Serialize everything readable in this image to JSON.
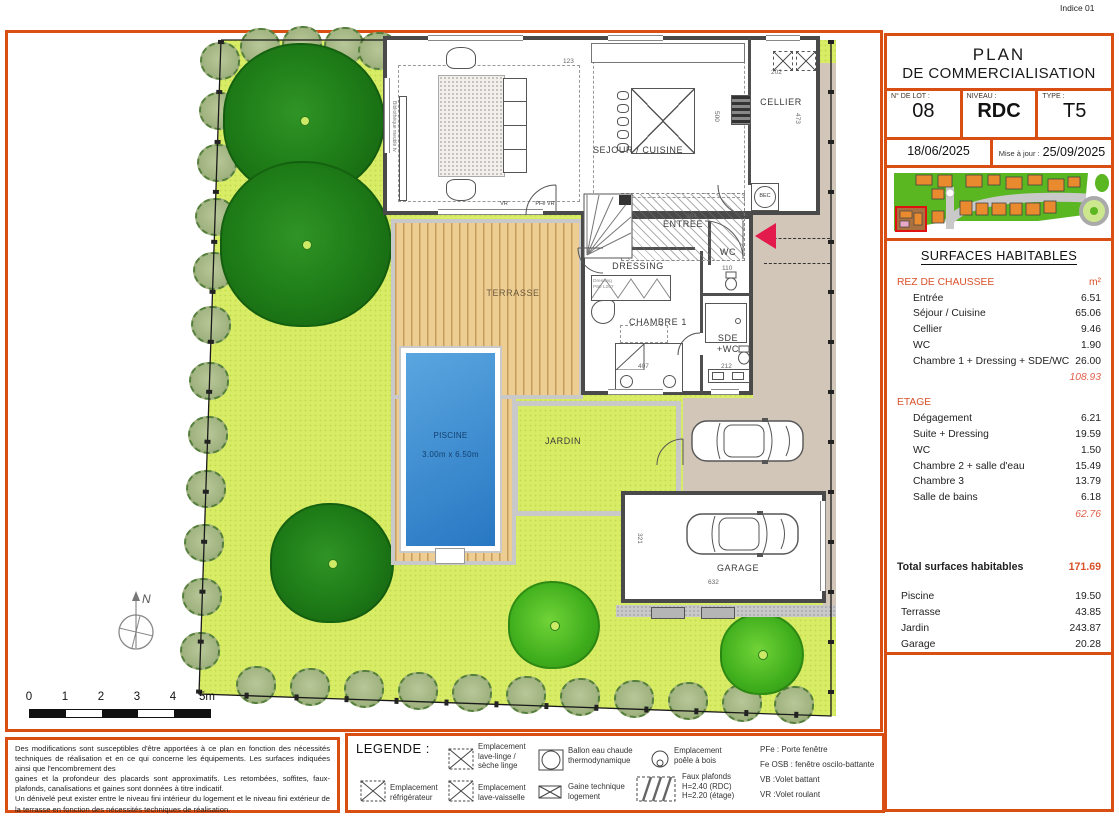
{
  "indice": "Indice 01",
  "title_block": {
    "line1": "PLAN",
    "line2": "DE COMMERCIALISATION",
    "lot_label": "N° DE LOT :",
    "lot_value": "08",
    "niveau_label": "NIVEAU :",
    "niveau_value": "RDC",
    "type_label": "TYPE :",
    "type_value": "T5",
    "date": "18/06/2025",
    "maj_label": "Mise à jour :",
    "maj_value": "25/09/2025"
  },
  "surfaces": {
    "title": "SURFACES HABITABLES",
    "unit": "m²",
    "rdc_label": "REZ DE CHAUSSEE",
    "rdc_rows": [
      {
        "label": "Entrée",
        "value": "6.51"
      },
      {
        "label": "Séjour / Cuisine",
        "value": "65.06"
      },
      {
        "label": "Cellier",
        "value": "9.46"
      },
      {
        "label": "WC",
        "value": "1.90"
      },
      {
        "label": "Chambre 1 + Dressing + SDE/WC",
        "value": "26.00"
      }
    ],
    "rdc_subtotal": "108.93",
    "etage_label": "ETAGE",
    "etage_rows": [
      {
        "label": "Dégagement",
        "value": "6.21"
      },
      {
        "label": "Suite + Dressing",
        "value": "19.59"
      },
      {
        "label": "WC",
        "value": "1.50"
      },
      {
        "label": "Chambre 2 + salle d'eau",
        "value": "15.49"
      },
      {
        "label": "Chambre 3",
        "value": "13.79"
      },
      {
        "label": "Salle de bains",
        "value": "6.18"
      }
    ],
    "etage_subtotal": "62.76",
    "total_label": "Total surfaces habitables",
    "total_value": "171.69",
    "annex_rows": [
      {
        "label": "Piscine",
        "value": "19.50"
      },
      {
        "label": "Terrasse",
        "value": "43.85"
      },
      {
        "label": "Jardin",
        "value": "243.87"
      },
      {
        "label": "Garage",
        "value": "20.28"
      }
    ]
  },
  "plan": {
    "labels": {
      "sejour": "SEJOUR / CUISINE",
      "cellier": "CELLIER",
      "entree": "ENTREE",
      "dressing": "DRESSING",
      "wc": "WC",
      "chambre1": "CHAMBRE 1",
      "sde": "SDE\n+WC",
      "terrasse": "TERRASSE",
      "jardin": "JARDIN",
      "garage": "GARAGE",
      "piscine": "PISCINE",
      "piscine_dim": "3.00m x 6.50m",
      "bec": "BEC",
      "biblio": "Bibliothèque meuble tv",
      "dressing_note": "Dressing\nP60 L267"
    },
    "tiny": {
      "vr": "VR",
      "pfe_vr": "PFe  VR"
    },
    "dimensions": [
      "123",
      "500",
      "202",
      "473",
      "364",
      "407",
      "212",
      "110",
      "632",
      "321"
    ],
    "scale_ticks": [
      "0",
      "1",
      "2",
      "3",
      "4",
      "5m"
    ],
    "north": "N"
  },
  "legend": {
    "title": "LEGENDE :",
    "items": [
      "Emplacement\nlave-linge /\nsèche linge",
      "Ballon eau chaude\nthermodynamique",
      "Emplacement\npoêle à bois",
      "Emplacement\nréfrigérateur",
      "Emplacement\nlave-vaisselle",
      "Gaine technique\nlogement",
      "Faux plafonds\nH=2.40 (RDC)\nH=2.20 (étage)"
    ],
    "abbreviations": [
      "PFe : Porte fenêtre",
      "Fe OSB : fenêtre oscilo-battante",
      "VB :Volet battant",
      "VR :Volet roulant"
    ]
  },
  "disclaimer": [
    "Des modifications sont susceptibles d'être apportées à ce plan en fonction des nécessités techniques de réalisation et en ce qui concerne les équipements. Les surfaces indiquées ainsi que l'encombrement des",
    "gaines et la profondeur des placards sont approximatifs. Les retombées, soffites, faux-plafonds, canalisations et gaines sont données à titre indicatif.",
    "Un dénivelé peut exister entre le niveau fini intérieur du logement et le niveau fini extérieur de la terrasse en fonction des nécessités techniques de réalisation."
  ],
  "colors": {
    "accent": "#d94e12",
    "garden": "#d8ec66",
    "pool": "#2877c2"
  }
}
